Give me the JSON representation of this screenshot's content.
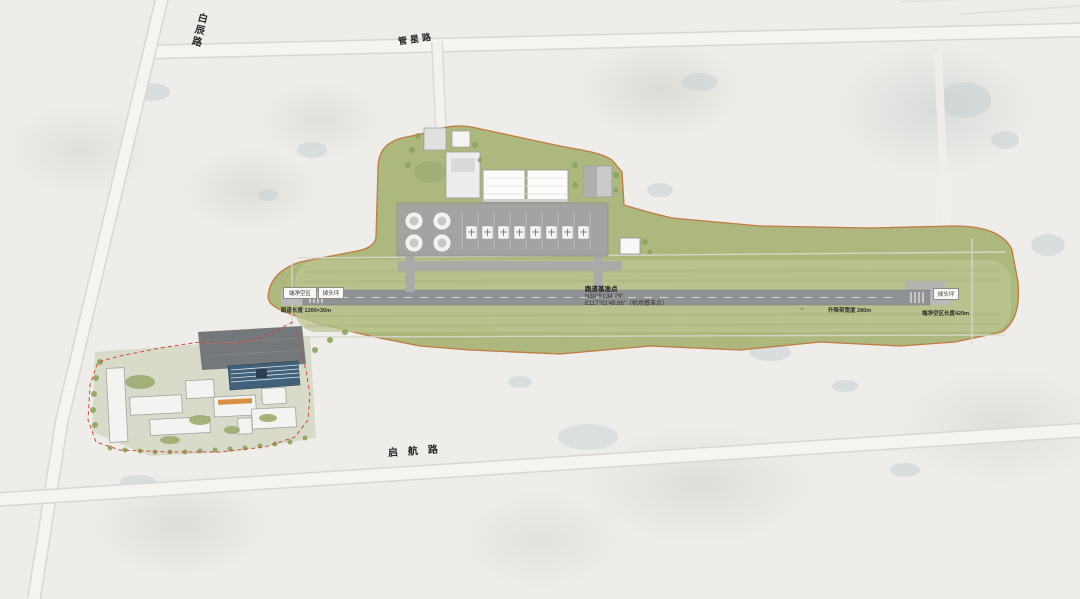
{
  "map_type": "airport-master-plan",
  "roads": {
    "top_left": {
      "label": "白辰路"
    },
    "top_center": {
      "label": "管星路"
    },
    "bottom": {
      "label": "启航路"
    }
  },
  "airfield": {
    "runway_annotation": {
      "title": "跑道基准点",
      "coord_lat": "N30°51′34.29″",
      "coord_lon": "E117°02′48.66″（机场基准点）"
    },
    "left_end": {
      "box_1": "端净空区",
      "box_2": "掉头坪",
      "note": "跑道长度 1200×30m"
    },
    "right_end": {
      "box": "掉头坪",
      "note": "端净空区长度420m"
    },
    "mid": {
      "arrow": "→",
      "note": "升降带宽度 280m"
    }
  },
  "colors": {
    "background": "#eeedea",
    "airfield_green": "#adb87e",
    "strip_green_light": "#bcc593",
    "runway_gray": "#8f9294",
    "stopway_gray": "#b7b9ba",
    "apron_gray": "#a2a4a2",
    "boundary_orange": "#c07a42",
    "red_dashed_line": "#cf4a3a",
    "pond_blue": "#c6d1d4",
    "blue_roof_building": "#41607a",
    "white_building": "#fbfbfa",
    "road_white": "#f5f4f1"
  }
}
